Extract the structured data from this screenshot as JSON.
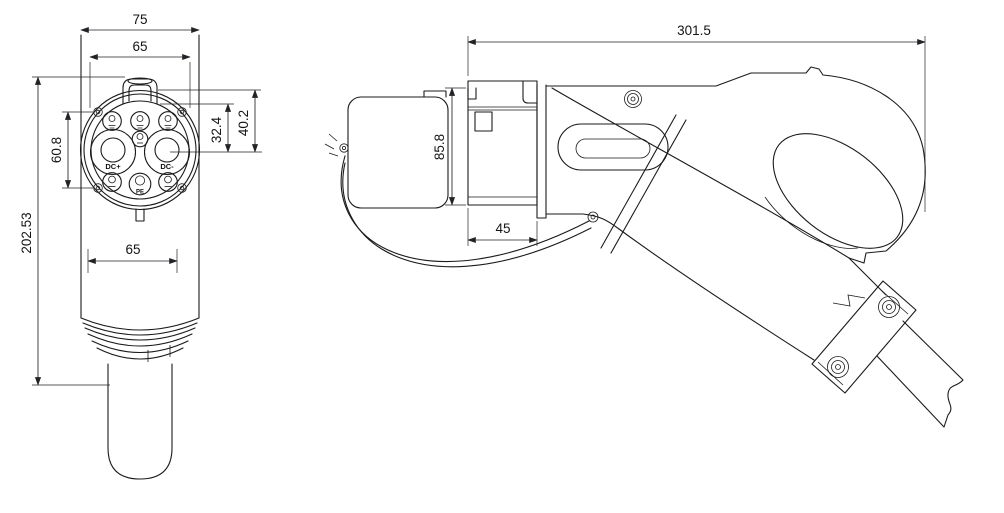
{
  "front_view": {
    "dimensions": {
      "overall_width": "75",
      "face_width": "65",
      "screw_spacing": "60.8",
      "pin_row_offset": "32.4",
      "face_height_offset": "40.2",
      "overall_height": "202.53",
      "body_width": "65"
    },
    "pin_labels": {
      "dc_plus": "DC+",
      "dc_minus": "DC-",
      "protective_earth": "PE"
    }
  },
  "side_view": {
    "dimensions": {
      "overall_length": "301.5",
      "coupler_height": "85.8",
      "coupler_depth": "45"
    }
  },
  "colors": {
    "line": "#1b1b1d",
    "dimension_line": "#222326",
    "text": "#141414",
    "background": "#ffffff"
  }
}
